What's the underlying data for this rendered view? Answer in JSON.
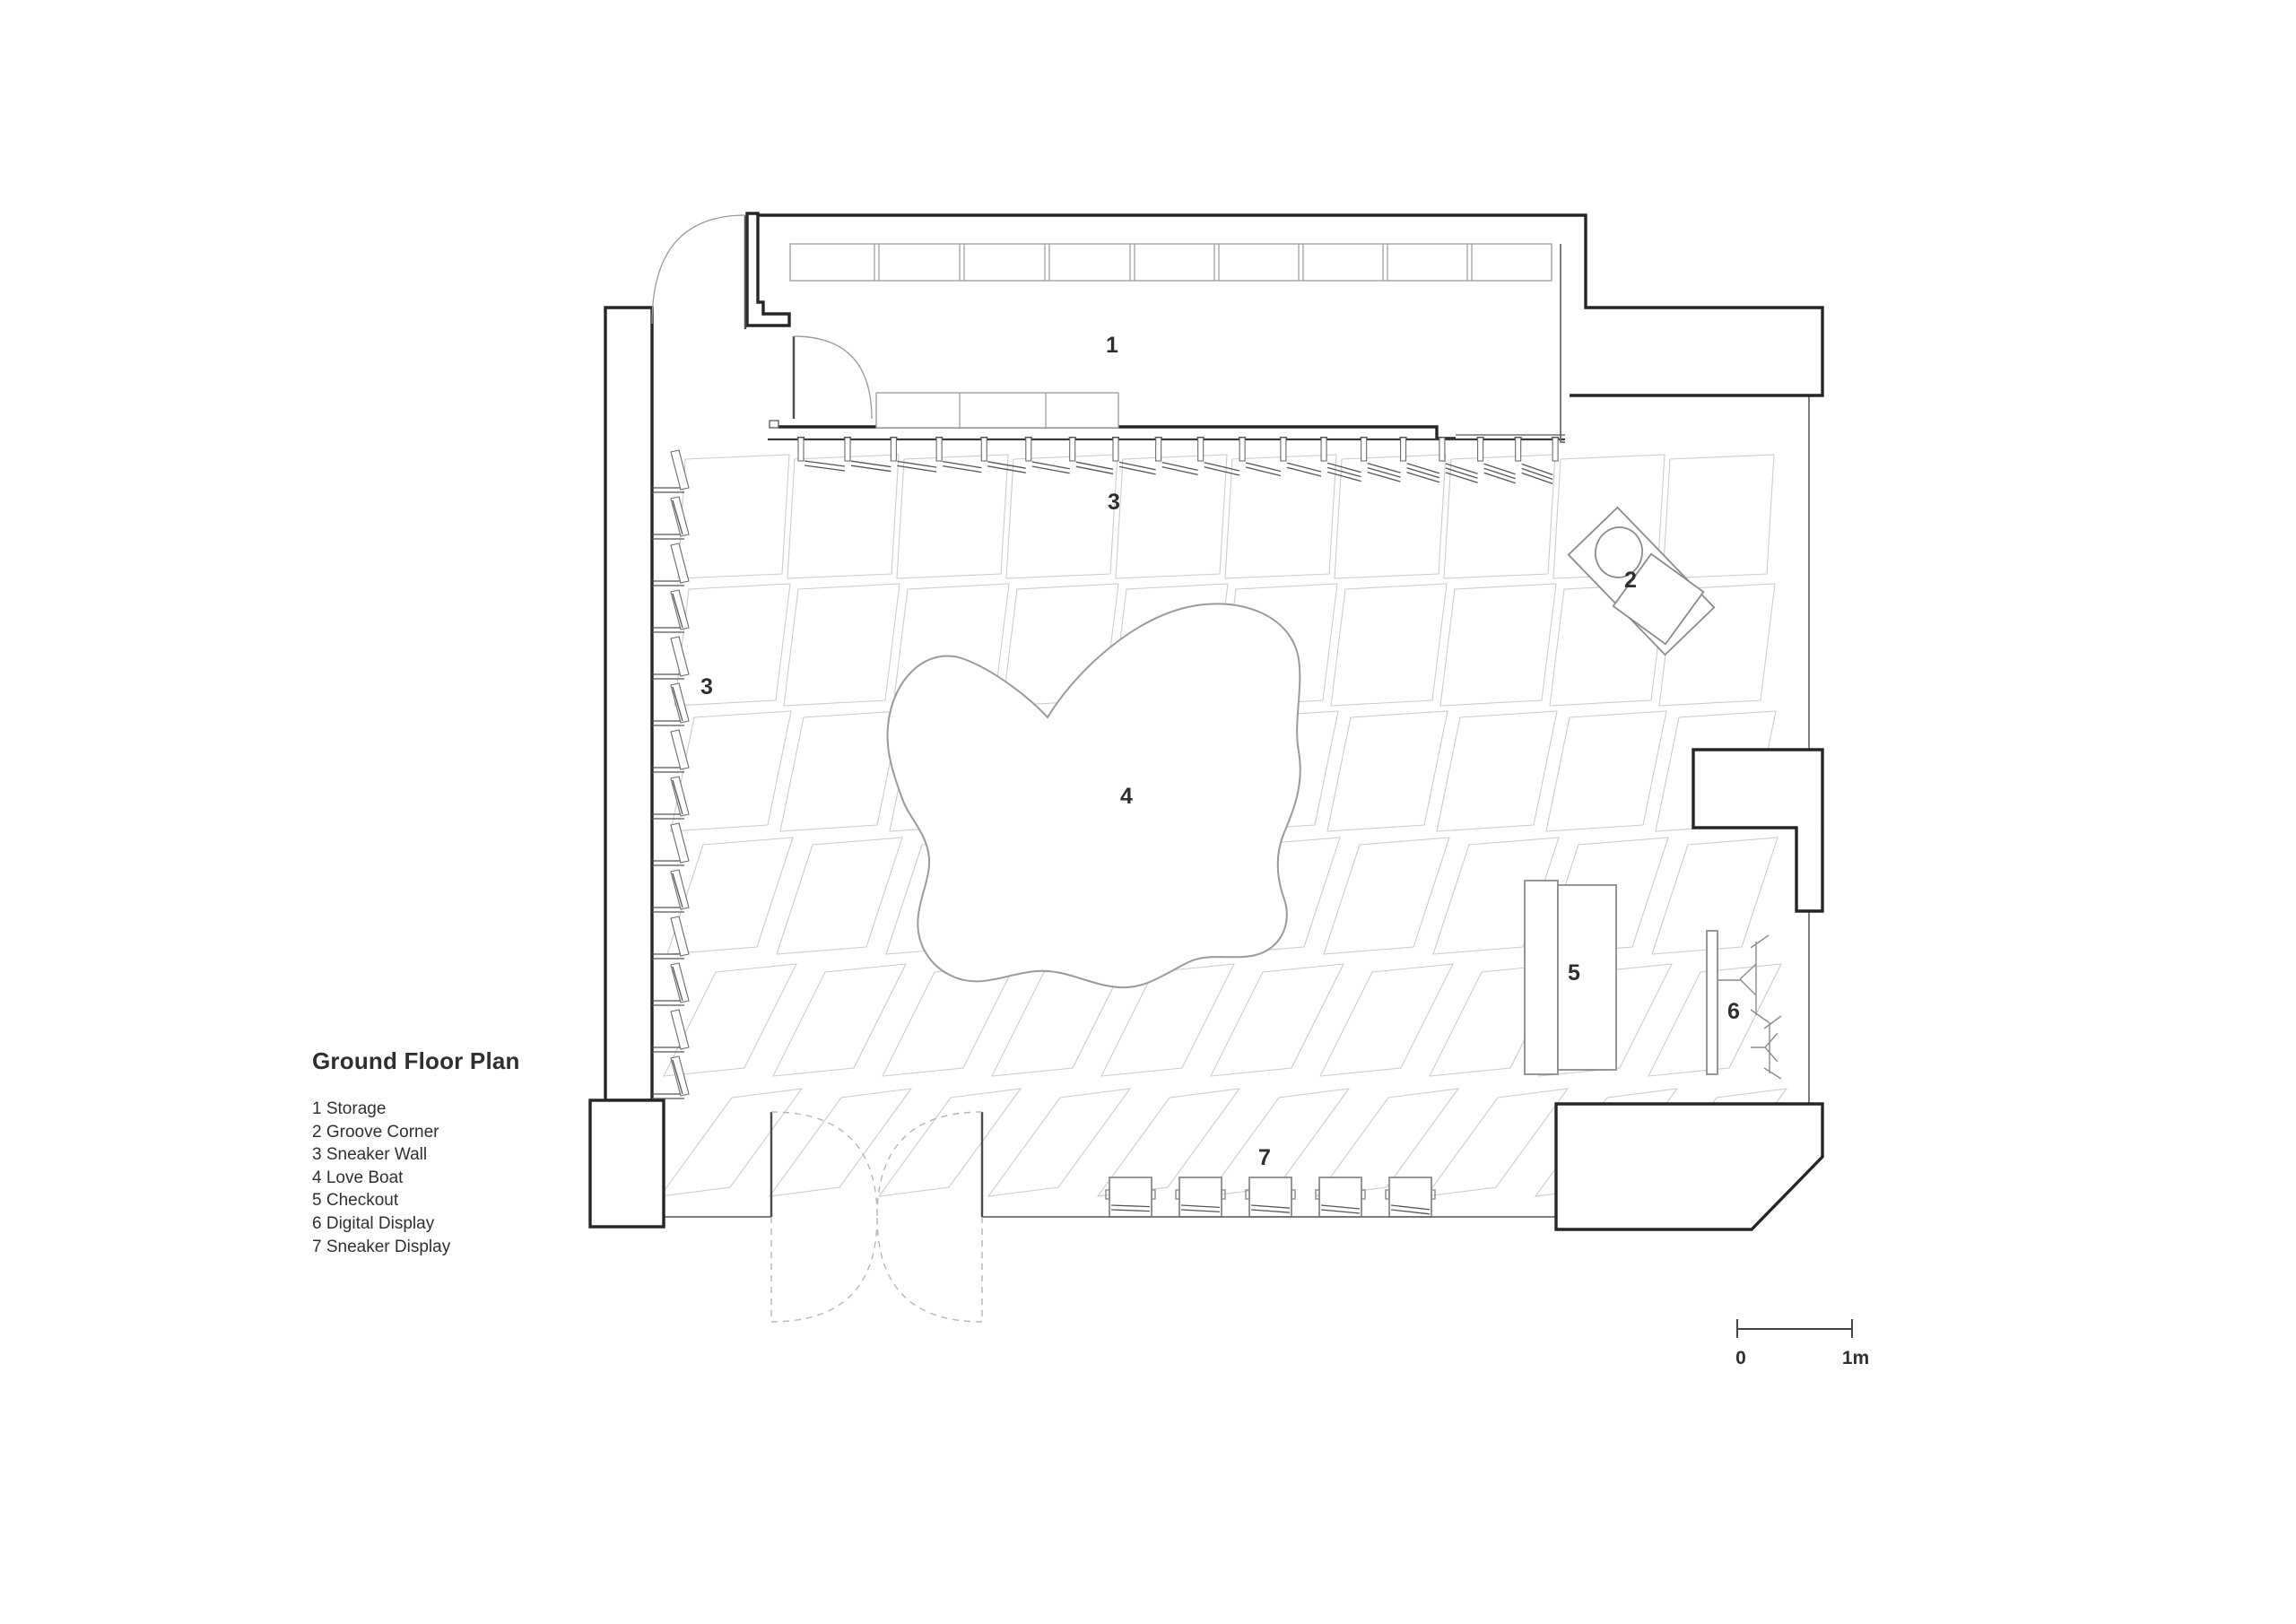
{
  "colors": {
    "background": "#ffffff",
    "wall": "#262626",
    "furniture": "#8a8a8a",
    "tile": "#cbcbcb",
    "dashed": "#b5b5b5",
    "fin": "#555555",
    "text": "#2f2f2f"
  },
  "title_block": {
    "title": "Ground Floor Plan"
  },
  "legend": {
    "items": [
      {
        "num": "1",
        "name": "Storage",
        "text": "1 Storage"
      },
      {
        "num": "2",
        "name": "Groove Corner",
        "text": "2 Groove Corner"
      },
      {
        "num": "3",
        "name": "Sneaker Wall",
        "text": "3 Sneaker Wall"
      },
      {
        "num": "4",
        "name": "Love Boat",
        "text": "4 Love Boat"
      },
      {
        "num": "5",
        "name": "Checkout",
        "text": "5 Checkout"
      },
      {
        "num": "6",
        "name": "Digital Display",
        "text": "6 Digital Display"
      },
      {
        "num": "7",
        "name": "Sneaker Display",
        "text": "7 Sneaker Display"
      }
    ]
  },
  "plan_labels": {
    "storage": "1",
    "groove_corner": "2",
    "sneaker_wall_top": "3",
    "sneaker_wall_left": "3",
    "love_boat": "4",
    "checkout": "5",
    "digital_display": "6",
    "sneaker_display": "7"
  },
  "scale_bar": {
    "start": "0",
    "end": "1m"
  }
}
